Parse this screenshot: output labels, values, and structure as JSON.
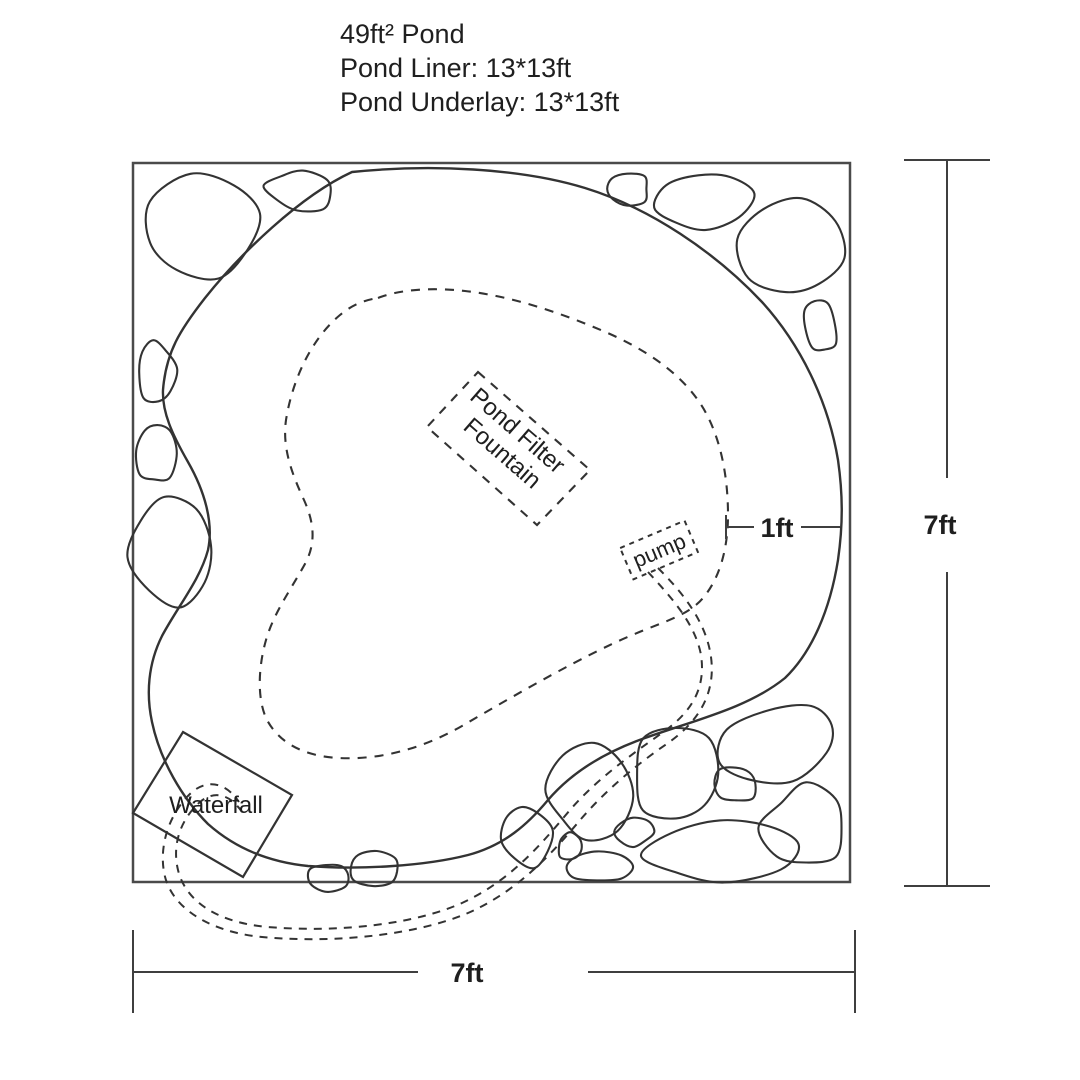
{
  "title_block": {
    "line1": "49ft² Pond",
    "line2": "Pond Liner: 13*13ft",
    "line3": "Pond Underlay: 13*13ft"
  },
  "labels": {
    "filter_line1": "Pond Filter",
    "filter_line2": "Fountain",
    "pump": "pump",
    "waterfall": "Waterfall",
    "shelf_offset": "1ft",
    "width_dim": "7ft",
    "height_dim": "7ft"
  },
  "colors": {
    "line": "#333333",
    "frame": "#4a4a4a",
    "dimension": "#3f3f3f",
    "text": "#1f1f1f"
  }
}
